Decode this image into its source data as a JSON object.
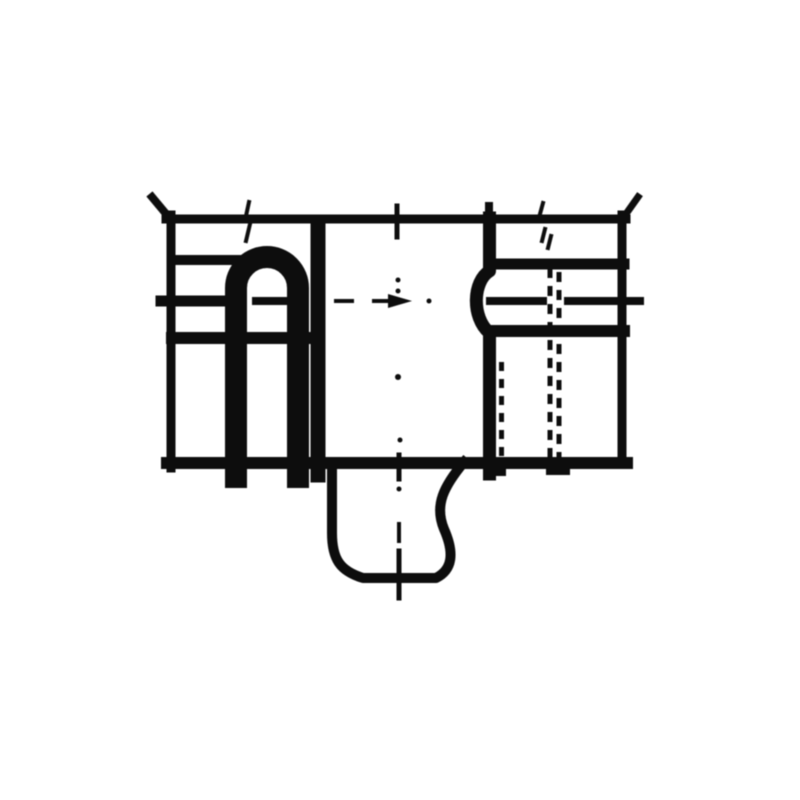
{
  "figure": {
    "subject": "wedge-base-lamp-technical-drawing",
    "background": "#ffffff",
    "ink": "#0d0d0d",
    "canvas": {
      "width": 800,
      "height": 800
    },
    "lines": [
      {
        "name": "top-outline",
        "x1": 166,
        "y1": 219,
        "x2": 626,
        "y2": 219,
        "w": 9
      },
      {
        "name": "pinch-tip-left",
        "x1": 172,
        "y1": 221,
        "x2": 152,
        "y2": 197,
        "w": 8
      },
      {
        "name": "pinch-tip-right",
        "x1": 621,
        "y1": 221,
        "x2": 638,
        "y2": 197,
        "w": 7
      },
      {
        "name": "left-outline",
        "x1": 171,
        "y1": 215,
        "x2": 171,
        "y2": 468,
        "w": 9
      },
      {
        "name": "right-outline",
        "x1": 622,
        "y1": 215,
        "x2": 622,
        "y2": 464,
        "w": 9
      },
      {
        "name": "bottom-outline",
        "x1": 167,
        "y1": 463,
        "x2": 627,
        "y2": 463,
        "w": 12
      },
      {
        "name": "left-band-upper",
        "x1": 172,
        "y1": 260,
        "x2": 240,
        "y2": 260,
        "w": 10
      },
      {
        "name": "left-band-middle",
        "x1": 161,
        "y1": 301,
        "x2": 240,
        "y2": 301,
        "w": 11
      },
      {
        "name": "left-band-lower",
        "x1": 172,
        "y1": 338,
        "x2": 313,
        "y2": 338,
        "w": 12
      },
      {
        "name": "filament-arch-tick",
        "x1": 256,
        "y1": 301,
        "x2": 285,
        "y2": 301,
        "w": 8
      },
      {
        "name": "divider-left",
        "x1": 318,
        "y1": 222,
        "x2": 318,
        "y2": 475,
        "w": 15
      },
      {
        "name": "right-band-upper",
        "x1": 492,
        "y1": 264,
        "x2": 624,
        "y2": 264,
        "w": 11
      },
      {
        "name": "right-centerline-seg-a",
        "x1": 490,
        "y1": 301,
        "x2": 543,
        "y2": 301,
        "w": 8
      },
      {
        "name": "right-centerline-seg-b",
        "x1": 568,
        "y1": 301,
        "x2": 640,
        "y2": 301,
        "w": 8
      },
      {
        "name": "right-band-lower",
        "x1": 492,
        "y1": 331,
        "x2": 624,
        "y2": 331,
        "w": 12
      },
      {
        "name": "divider-right-top-stub",
        "x1": 489,
        "y1": 206,
        "x2": 489,
        "y2": 224,
        "w": 8
      },
      {
        "name": "axis-tick-top",
        "x1": 397,
        "y1": 206,
        "x2": 397,
        "y2": 237,
        "w": 5
      },
      {
        "name": "axis-tick-bottom-cross",
        "x1": 399,
        "y1": 455,
        "x2": 399,
        "y2": 479,
        "w": 5
      },
      {
        "name": "axis-tick-wedge-cross",
        "x1": 399,
        "y1": 551,
        "x2": 399,
        "y2": 598,
        "w": 5
      },
      {
        "name": "axis-dash-center",
        "x1": 336,
        "y1": 301,
        "x2": 352,
        "y2": 301,
        "w": 4
      },
      {
        "name": "axis-arrow-tail",
        "x1": 374,
        "y1": 301,
        "x2": 389,
        "y2": 301,
        "w": 4
      },
      {
        "name": "axis-dash-wedge",
        "x1": 399,
        "y1": 524,
        "x2": 399,
        "y2": 541,
        "w": 4
      },
      {
        "name": "hidden-line-outer-a",
        "x1": 550,
        "y1": 268,
        "x2": 550,
        "y2": 458,
        "w": 5,
        "dash": "10 8"
      },
      {
        "name": "hidden-line-outer-b",
        "x1": 559,
        "y1": 272,
        "x2": 559,
        "y2": 458,
        "w": 5,
        "dash": "10 8"
      },
      {
        "name": "hidden-line-inner-a",
        "x1": 492.5,
        "y1": 366,
        "x2": 492.5,
        "y2": 458,
        "w": 5,
        "dash": "9 8"
      },
      {
        "name": "hidden-line-inner-b",
        "x1": 501.5,
        "y1": 362,
        "x2": 501.5,
        "y2": 458,
        "w": 5,
        "dash": "9 8"
      },
      {
        "name": "double-tick-left-a",
        "x1": 249,
        "y1": 202,
        "x2": 246,
        "y2": 216,
        "w": 4
      },
      {
        "name": "double-tick-left-b",
        "x1": 250,
        "y1": 224,
        "x2": 246,
        "y2": 241,
        "w": 4
      },
      {
        "name": "double-tick-right-a",
        "x1": 543,
        "y1": 203,
        "x2": 540,
        "y2": 214,
        "w": 4
      },
      {
        "name": "double-tick-right-b",
        "x1": 545,
        "y1": 229,
        "x2": 542,
        "y2": 241,
        "w": 4
      },
      {
        "name": "double-tick-right-c",
        "x1": 551,
        "y1": 236,
        "x2": 548,
        "y2": 248,
        "w": 4
      }
    ],
    "paths": [
      {
        "name": "filament-support-arch",
        "d": "M 236 477 L 236 288 A 31 31 0 0 1 298 288 L 298 477",
        "w": 22
      },
      {
        "name": "divider-right-bulged",
        "d": "M 489.5 218 L 489.5 271 C 473 281 471 317 489.5 333 L 489.5 474",
        "w": 13
      },
      {
        "name": "wedge-base-outline",
        "d": "M 332 462 L 332 533 C 332 559 340 571 363 578 L 436 578 C 452 570 455 554 444 529 C 434 505 444 486 464 462",
        "w": 10
      }
    ],
    "rects": [
      {
        "name": "lead-stub-left",
        "x": 484,
        "y": 460,
        "w": 22,
        "h": 16
      },
      {
        "name": "lead-stub-right",
        "x": 546,
        "y": 460,
        "w": 24,
        "h": 15
      }
    ],
    "dots": [
      {
        "name": "axis-dot-1",
        "cx": 398,
        "cy": 280,
        "r": 2.5
      },
      {
        "name": "axis-dot-2",
        "cx": 398,
        "cy": 291,
        "r": 2.5
      },
      {
        "name": "axis-dot-3",
        "cx": 398,
        "cy": 377,
        "r": 3
      },
      {
        "name": "axis-dot-4",
        "cx": 400,
        "cy": 440,
        "r": 2.5
      },
      {
        "name": "axis-dot-5",
        "cx": 399,
        "cy": 489,
        "r": 2.5
      },
      {
        "name": "axis-dot-6",
        "cx": 429,
        "cy": 301,
        "r": 2.5
      }
    ],
    "polygons": [
      {
        "name": "axis-arrowhead",
        "points": "388,294 388,308 412,301"
      }
    ]
  }
}
